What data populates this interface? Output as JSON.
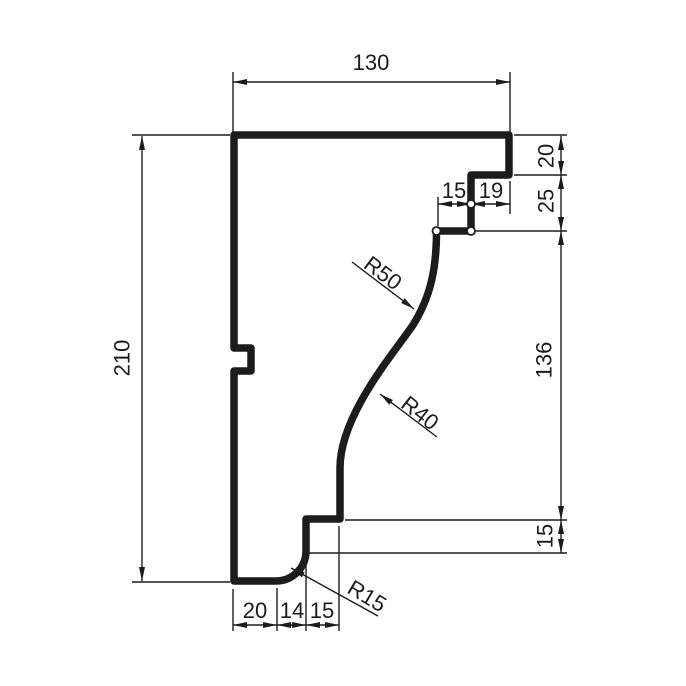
{
  "drawing": {
    "kind": "molding-profile-cross-section",
    "line_color": "#1c1c1c",
    "background_color": "#ffffff"
  },
  "dimensions": {
    "overall_width": "130",
    "overall_height": "210",
    "right_chain": [
      "20",
      "25",
      "136",
      "15"
    ],
    "top_step_chain": [
      "15",
      "19"
    ],
    "bottom_chain": [
      "20",
      "14",
      "15"
    ],
    "radii": {
      "upper": "R50",
      "middle": "R40",
      "lower": "R15"
    }
  }
}
